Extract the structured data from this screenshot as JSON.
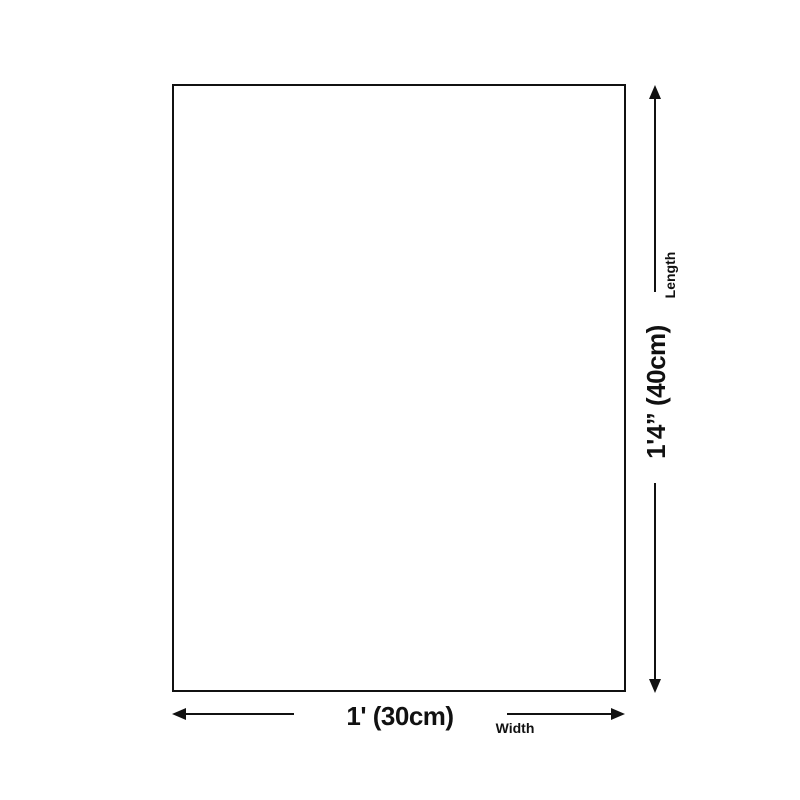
{
  "colors": {
    "background": "#ffffff",
    "line": "#111111"
  },
  "diagram": {
    "type": "product-size-dimension-diagram",
    "length": {
      "value": "1'4” (40cm)",
      "label": "Length"
    },
    "width": {
      "value": "1' (30cm)",
      "label": "Width"
    }
  }
}
